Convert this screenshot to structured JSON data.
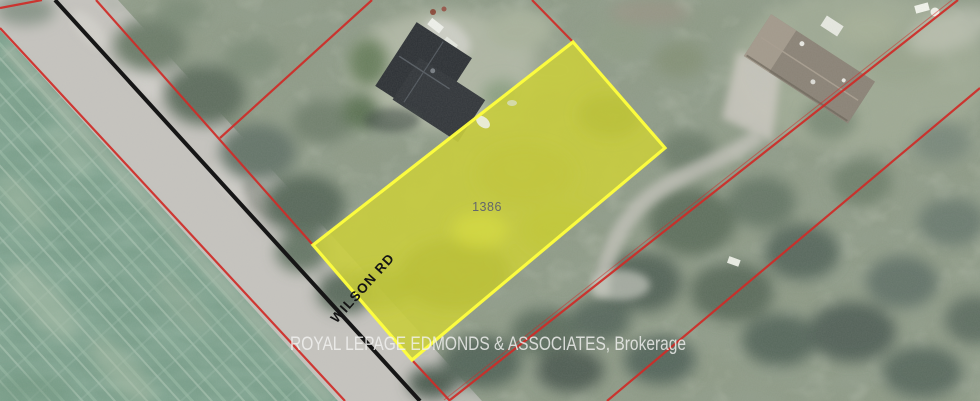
{
  "map": {
    "watermark": "ROYAL LEPAGE EDMONDS & ASSOCIATES, Brokerage",
    "road": {
      "label": "WILSON RD",
      "centerline_color": "#161616"
    },
    "subject_parcel": {
      "number": "1386",
      "fill_color": "#c9cd3e",
      "border_color": "#ffff3d"
    },
    "boundary_color": "#cf2b27"
  }
}
